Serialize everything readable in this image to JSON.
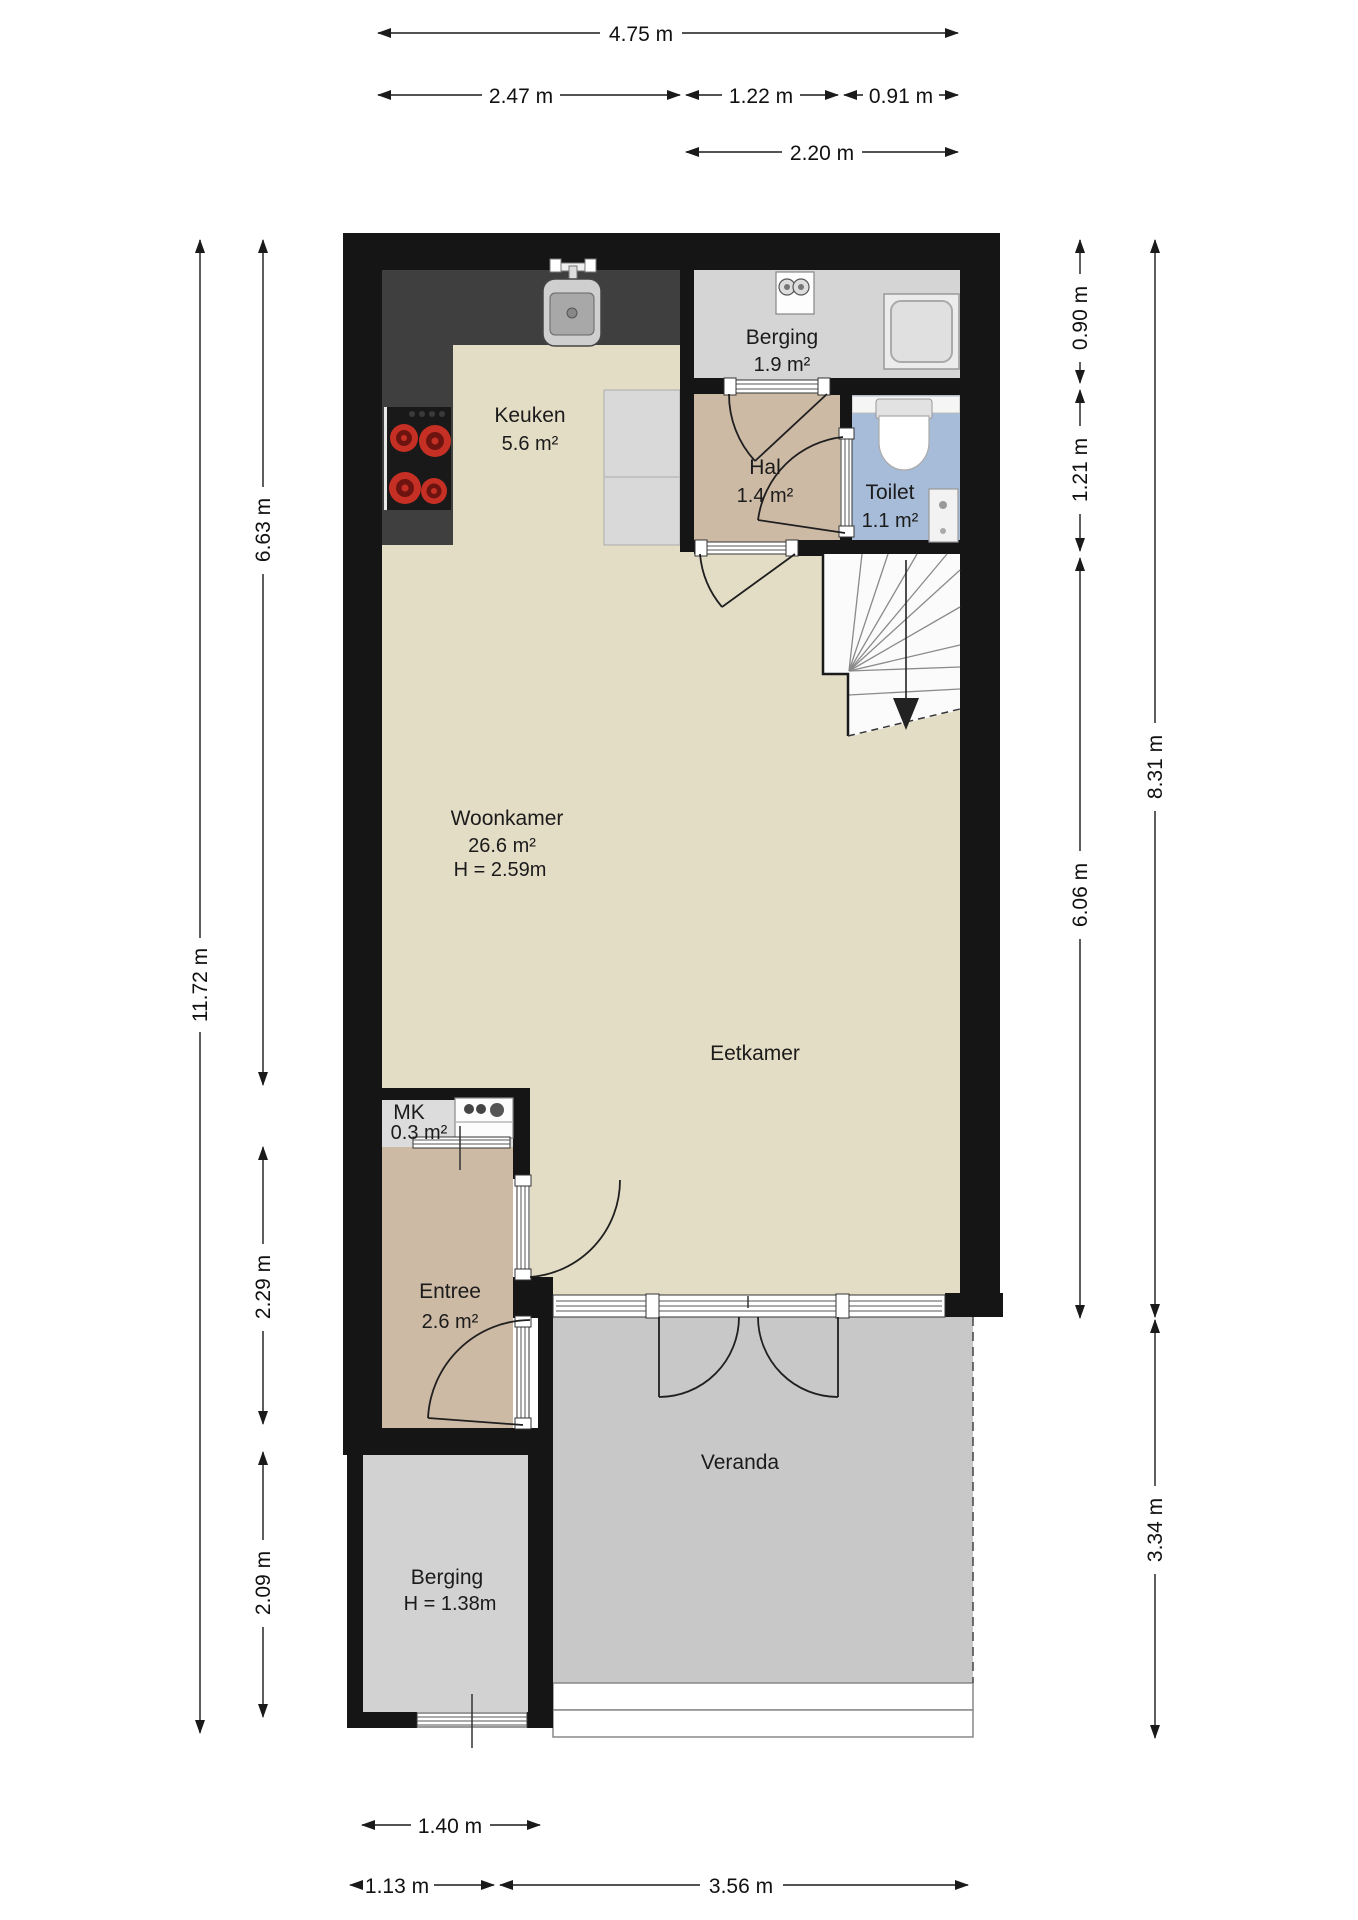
{
  "plan": {
    "rooms": {
      "keuken": {
        "label": "Keuken",
        "area": "5.6 m²"
      },
      "berging_boven": {
        "label": "Berging",
        "area": "1.9 m²"
      },
      "hal": {
        "label": "Hal",
        "area": "1.4 m²"
      },
      "toilet": {
        "label": "Toilet",
        "area": "1.1 m²"
      },
      "woonkamer": {
        "label": "Woonkamer",
        "area": "26.6 m²",
        "ceiling": "H = 2.59m"
      },
      "eetkamer": {
        "label": "Eetkamer"
      },
      "mk": {
        "label": "MK",
        "area": "0.3 m²"
      },
      "entree": {
        "label": "Entree",
        "area": "2.6 m²"
      },
      "berging_beneden": {
        "label": "Berging",
        "ceiling": "H = 1.38m"
      },
      "veranda": {
        "label": "Veranda"
      }
    },
    "dimensions": {
      "top_total": "4.75 m",
      "top_row2": [
        "2.47 m",
        "1.22 m",
        "0.91 m"
      ],
      "top_row3": "2.20 m",
      "left_total": "11.72 m",
      "left_segments": [
        "6.63 m",
        "2.29 m",
        "2.09 m"
      ],
      "right_inner": [
        "0.90 m",
        "1.21 m",
        "6.06 m"
      ],
      "right_outer": [
        "8.31 m",
        "3.34 m"
      ],
      "bottom_row1": "1.40 m",
      "bottom_row2": [
        "1.13 m",
        "3.56 m"
      ]
    },
    "colors": {
      "wall": "#151515",
      "floor_living": "#e4ddc6",
      "floor_hall": "#cdbaa5",
      "floor_storage": "#d5d5d5",
      "floor_toilet": "#a7bcd8",
      "floor_veranda": "#c8c8c8",
      "counter": "#3f3f3f",
      "burner": "#c63024"
    }
  }
}
